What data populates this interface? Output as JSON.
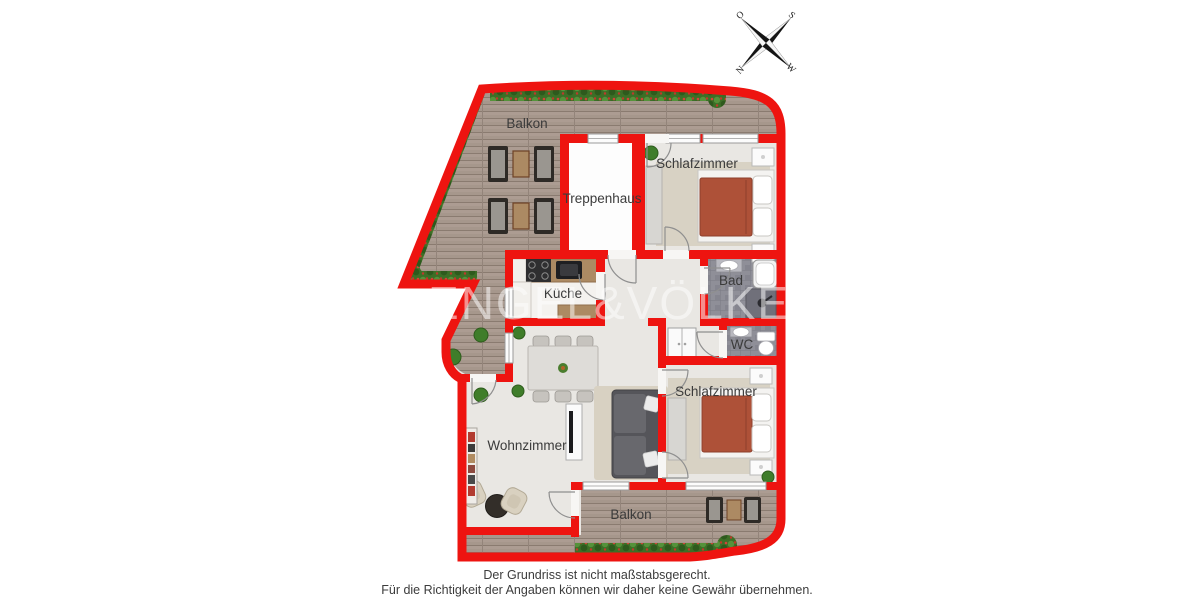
{
  "compass": {
    "o": "O",
    "s": "S",
    "n": "N",
    "w": "W"
  },
  "labels": {
    "balcony_top": "Balkon",
    "staircase": "Treppenhaus",
    "bedroom_top": "Schlafzimmer",
    "kitchen": "Küche",
    "bathroom": "Bad",
    "wc": "WC",
    "living_room": "Wohnzimmer",
    "bedroom_bottom": "Schlafzimmer",
    "balcony_bottom": "Balkon"
  },
  "watermark": "ENGEL&VÖLKERS",
  "disclaimer": {
    "line1": "Der Grundriss ist nicht maßstabsgerecht.",
    "line2": "Für die Richtigkeit der Angaben können wir daher keine Gewähr übernehmen."
  },
  "colors": {
    "wall": "#ee1410",
    "deck": "#a6978c",
    "floor": "#e9e7e3",
    "tile": "#8f8f98",
    "bed_blanket": "#ae5138",
    "wood": "#ac8a63",
    "label_text": "#3b3b3b"
  }
}
